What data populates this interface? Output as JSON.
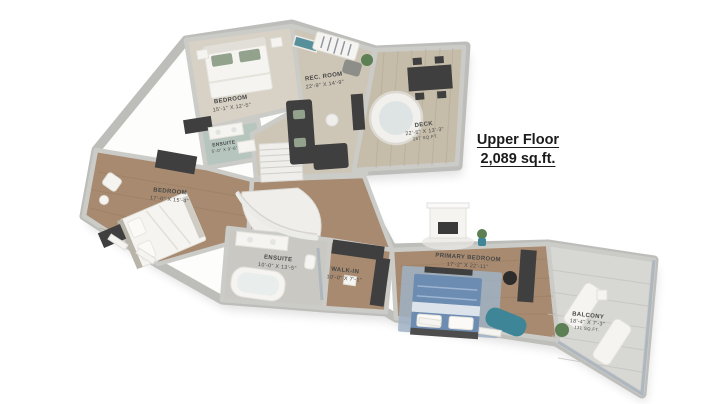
{
  "title": {
    "line1": "Upper Floor",
    "line2": "2,089 sq.ft."
  },
  "rooms": [
    {
      "name": "BEDROOM",
      "dims": "15'-1\" X 12'-5\""
    },
    {
      "name": "REC. ROOM",
      "dims": "22'-9\" X 14'-9\""
    },
    {
      "name": "ENSUITE",
      "dims": "5'-0\" X 9'-6\""
    },
    {
      "name": "DECK",
      "dims": "22'-5\" X 13'-3\"",
      "area": "287 SQ.FT."
    },
    {
      "name": "BEDROOM",
      "dims": "17'-0\" X 15'-4\""
    },
    {
      "name": "ENSUITE",
      "dims": "10'-0\" X 13'-5\""
    },
    {
      "name": "WALK-IN",
      "dims": "10'-0\" X 7'-1\""
    },
    {
      "name": "PRIMARY BEDROOM",
      "dims": "17'-2\" X 22'-11\""
    },
    {
      "name": "BALCONY",
      "dims": "18'-4\" X 7'-3\"",
      "area": "131 SQ.FT."
    }
  ],
  "colors": {
    "bg": "#ffffff",
    "wall": "#cbcbc8",
    "wallOuter": "#bdbdba",
    "wood": "#a78a6f",
    "woodLine": "#8d7257",
    "carpet": "#cdc5b5",
    "carpetLight": "#d8d1c5",
    "deckWood": "#c6bcaa",
    "deckLine": "#b3a894",
    "tile": "#c9c8c3",
    "tealFloor": "#b6c6bf",
    "balconyFloor": "#d7d7d4",
    "balconyLine": "#c3c3c0",
    "darkFurniture": "#3f3f3f",
    "whiteFurniture": "#f5f4f0",
    "tealAccent": "#3e8597",
    "blueBedding": "#6d8cb1",
    "rug": "#9fb2c4",
    "plant": "#5d7f54",
    "glass": "#a9b4bd",
    "labelText": "#474747",
    "titleText": "#1b1b1b",
    "pillowGreen": "#93a28c",
    "stair": "#efeeeb"
  }
}
